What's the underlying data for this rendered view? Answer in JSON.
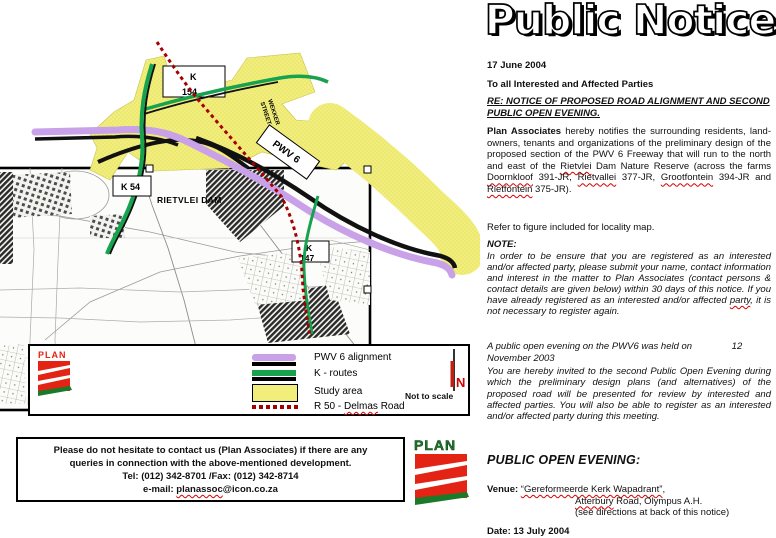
{
  "notice": {
    "title": "Public Notice",
    "date": "17 June 2004",
    "salutation": "To all Interested and Affected Parties",
    "re1": "RE: NOTICE OF PROPOSED ROAD ALIGNMENT AND SECOND",
    "re2": "PUBLIC OPEN EVENING.",
    "p1": {
      "s0": "Plan Associates",
      "s1": " hereby notifies the surrounding residents, land-owners, tenants and organizations of the preliminary design of the proposed section of the PWV 6 Freeway that will run to the north and east of the ",
      "w1": "Rietvlei",
      "s2": " Dam Nature Reserve (across the farms ",
      "w2": "Doornkloof",
      "s3": " 391-JR, ",
      "w3": "Rietvallei",
      "s4": " 377-JR, ",
      "w4": "Grootfontein",
      "s5": " 394-JR and ",
      "w5": "Rietfontein",
      "s6": " 375-JR)."
    },
    "p2": "Refer to figure included for locality map.",
    "note_label": "NOTE:",
    "p3": {
      "s0": "In order to be ensure that you are registered as an interested and/or affected party, please submit your name, contact information and interest in the matter to Plan Associates (contact persons & contact details are given below) within 30 days of this notice. If you have already registered as an interested and/or affected ",
      "w0": "party",
      "s1": ", it is not necessary to register again."
    },
    "p4": "A public open evening on the PWV6 was held on               12\nNovember 2003",
    "p5": "You are hereby invited to  the second Public Open Evening during which the preliminary design plans (and alternatives) of the proposed road will be presented for review by interested and affected parties.  You will also be able to register as an interested and/or affected party during this meeting.",
    "poe_heading": "PUBLIC OPEN EVENING:",
    "venue_label": "Venue: ",
    "venue_name": "“Gereformeerde Kerk Wapadrant”",
    "venue_comma": ",",
    "venue_l2_wavy": "Atterbury",
    "venue_l2_rest": " Road, Olympus A.H.",
    "venue_l3": "(see directions at back of this notice)",
    "clipped_date": "Date: 13 July 2004"
  },
  "contact_box": {
    "line1": "Please do not hesitate to contact us (Plan Associates) if there are any",
    "line2": "queries in connection with the above-mentioned development.",
    "line3": "Tel: (012) 342-8701 /Fax: (012) 342-8714",
    "line4_prefix": "e-mail: ",
    "line4_email": "planassoc",
    "line4_domain": "@icon.co.za"
  },
  "figure": {
    "map_label": "RIETVLEI DAM",
    "k154_l1": "K",
    "k154_l2": "154",
    "k54": "K 54",
    "k147_l1": "K",
    "k147_l2": "147",
    "pwv6_label": "PWV 6",
    "street_l1": "WEKKER",
    "street_l2": "STREET",
    "legend": {
      "item1": "PWV 6 alignment",
      "item2": "K - routes",
      "item3": "Study area",
      "item4_pre": "R 50 - ",
      "item4_wavy": "Delmas",
      "item4_post": " Road",
      "north_n": "N",
      "not_to_scale": "Not to scale"
    },
    "plan_small": "PLAN",
    "plan_large": "PLAN",
    "colors": {
      "study_yellow": "#F2EE7C",
      "pwv_purple": "#C9A1E9",
      "route_green": "#17A24E",
      "r50_red": "#A50000",
      "logo_red": "#E32313",
      "logo_green": "#1B7A2A"
    }
  }
}
